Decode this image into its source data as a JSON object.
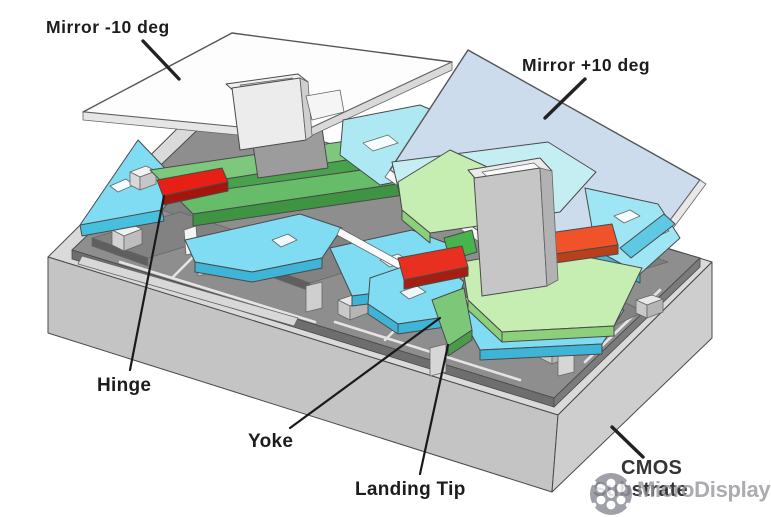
{
  "labels": {
    "mirror_neg": "Mirror -10 deg",
    "mirror_pos": "Mirror +10 deg",
    "hinge": "Hinge",
    "yoke": "Yoke",
    "landing_tip": "Landing Tip",
    "cmos_line1": "CMOS",
    "cmos_line2": "Substrate"
  },
  "watermark": {
    "text": "MicroDisplay",
    "logo": "flower-icon"
  },
  "colors": {
    "mirror_white": "#fdfdfd",
    "mirror_blue": "#ccdcec",
    "plate_cyan": "#7fdcf2",
    "plate_cyan_side": "#3eb4d6",
    "plate_cyan_pale": "#aee8f2",
    "yoke_green": "#7ec87e",
    "yoke_green_side": "#48a24c",
    "yoke_pale_green": "#c6eeb2",
    "hinge_red": "#e81f14",
    "hinge_orange_red": "#f0522a",
    "substrate_gray": "#c4c4c4",
    "metal_gray": "#8e8e8e",
    "label_text": "#1c1c1c",
    "watermark_gray": "#95959b"
  }
}
